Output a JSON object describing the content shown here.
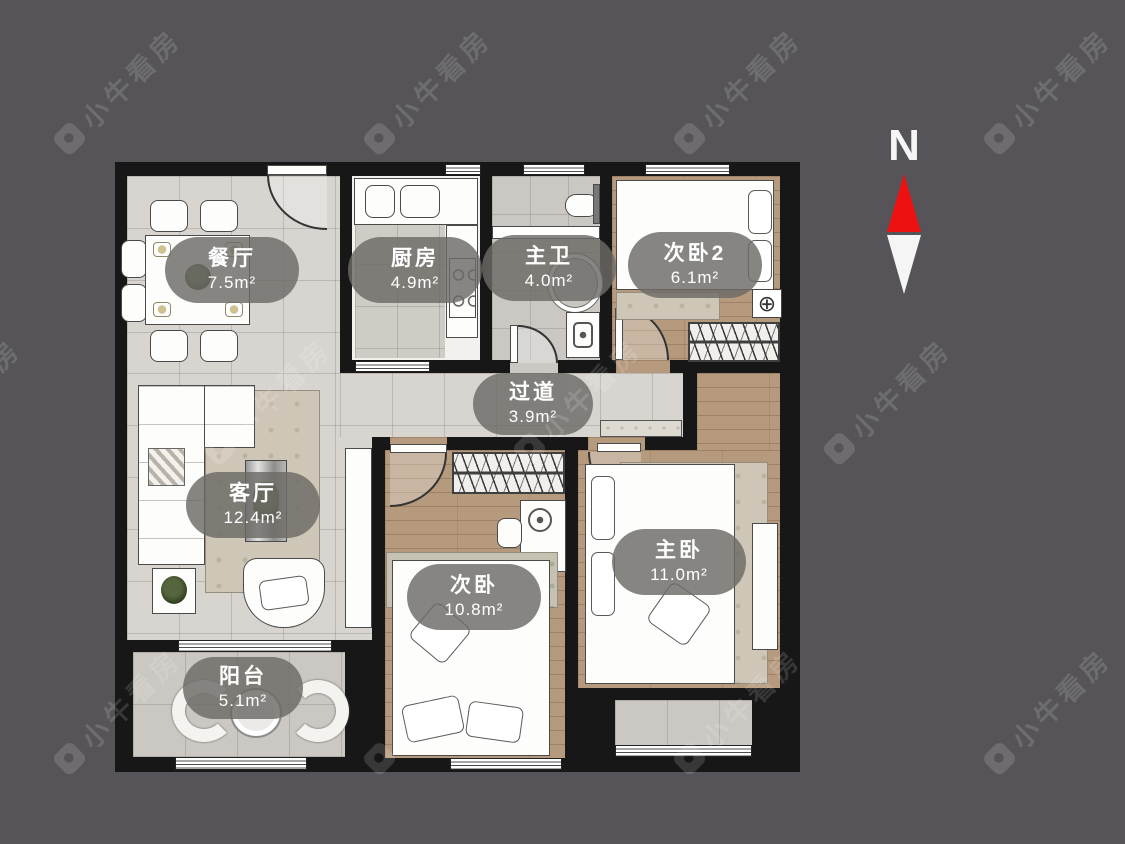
{
  "watermark": {
    "text": "小牛看房"
  },
  "compass": {
    "label": "N",
    "arrow_colors": {
      "north": "#ed1111",
      "south": "#f5f5f5"
    }
  },
  "rooms": [
    {
      "id": "dining",
      "name": "餐厅",
      "area": "7.5m²"
    },
    {
      "id": "kitchen",
      "name": "厨房",
      "area": "4.9m²"
    },
    {
      "id": "master-bath",
      "name": "主卫",
      "area": "4.0m²"
    },
    {
      "id": "bedroom2",
      "name": "次卧2",
      "area": "6.1m²"
    },
    {
      "id": "hallway",
      "name": "过道",
      "area": "3.9m²"
    },
    {
      "id": "living",
      "name": "客厅",
      "area": "12.4m²"
    },
    {
      "id": "bedroom",
      "name": "次卧",
      "area": "10.8m²"
    },
    {
      "id": "master-bedroom",
      "name": "主卧",
      "area": "11.0m²"
    },
    {
      "id": "balcony",
      "name": "阳台",
      "area": "5.1m²"
    }
  ],
  "symbols": {
    "ac_unit": "⊕"
  },
  "colors": {
    "background": "#565458",
    "wall": "#171717",
    "tile_floor": "#d8d5d0",
    "wood_floor": "#b59a7e",
    "label_pill": "rgba(108,106,103,0.82)",
    "compass_north_red": "#ed1111"
  }
}
